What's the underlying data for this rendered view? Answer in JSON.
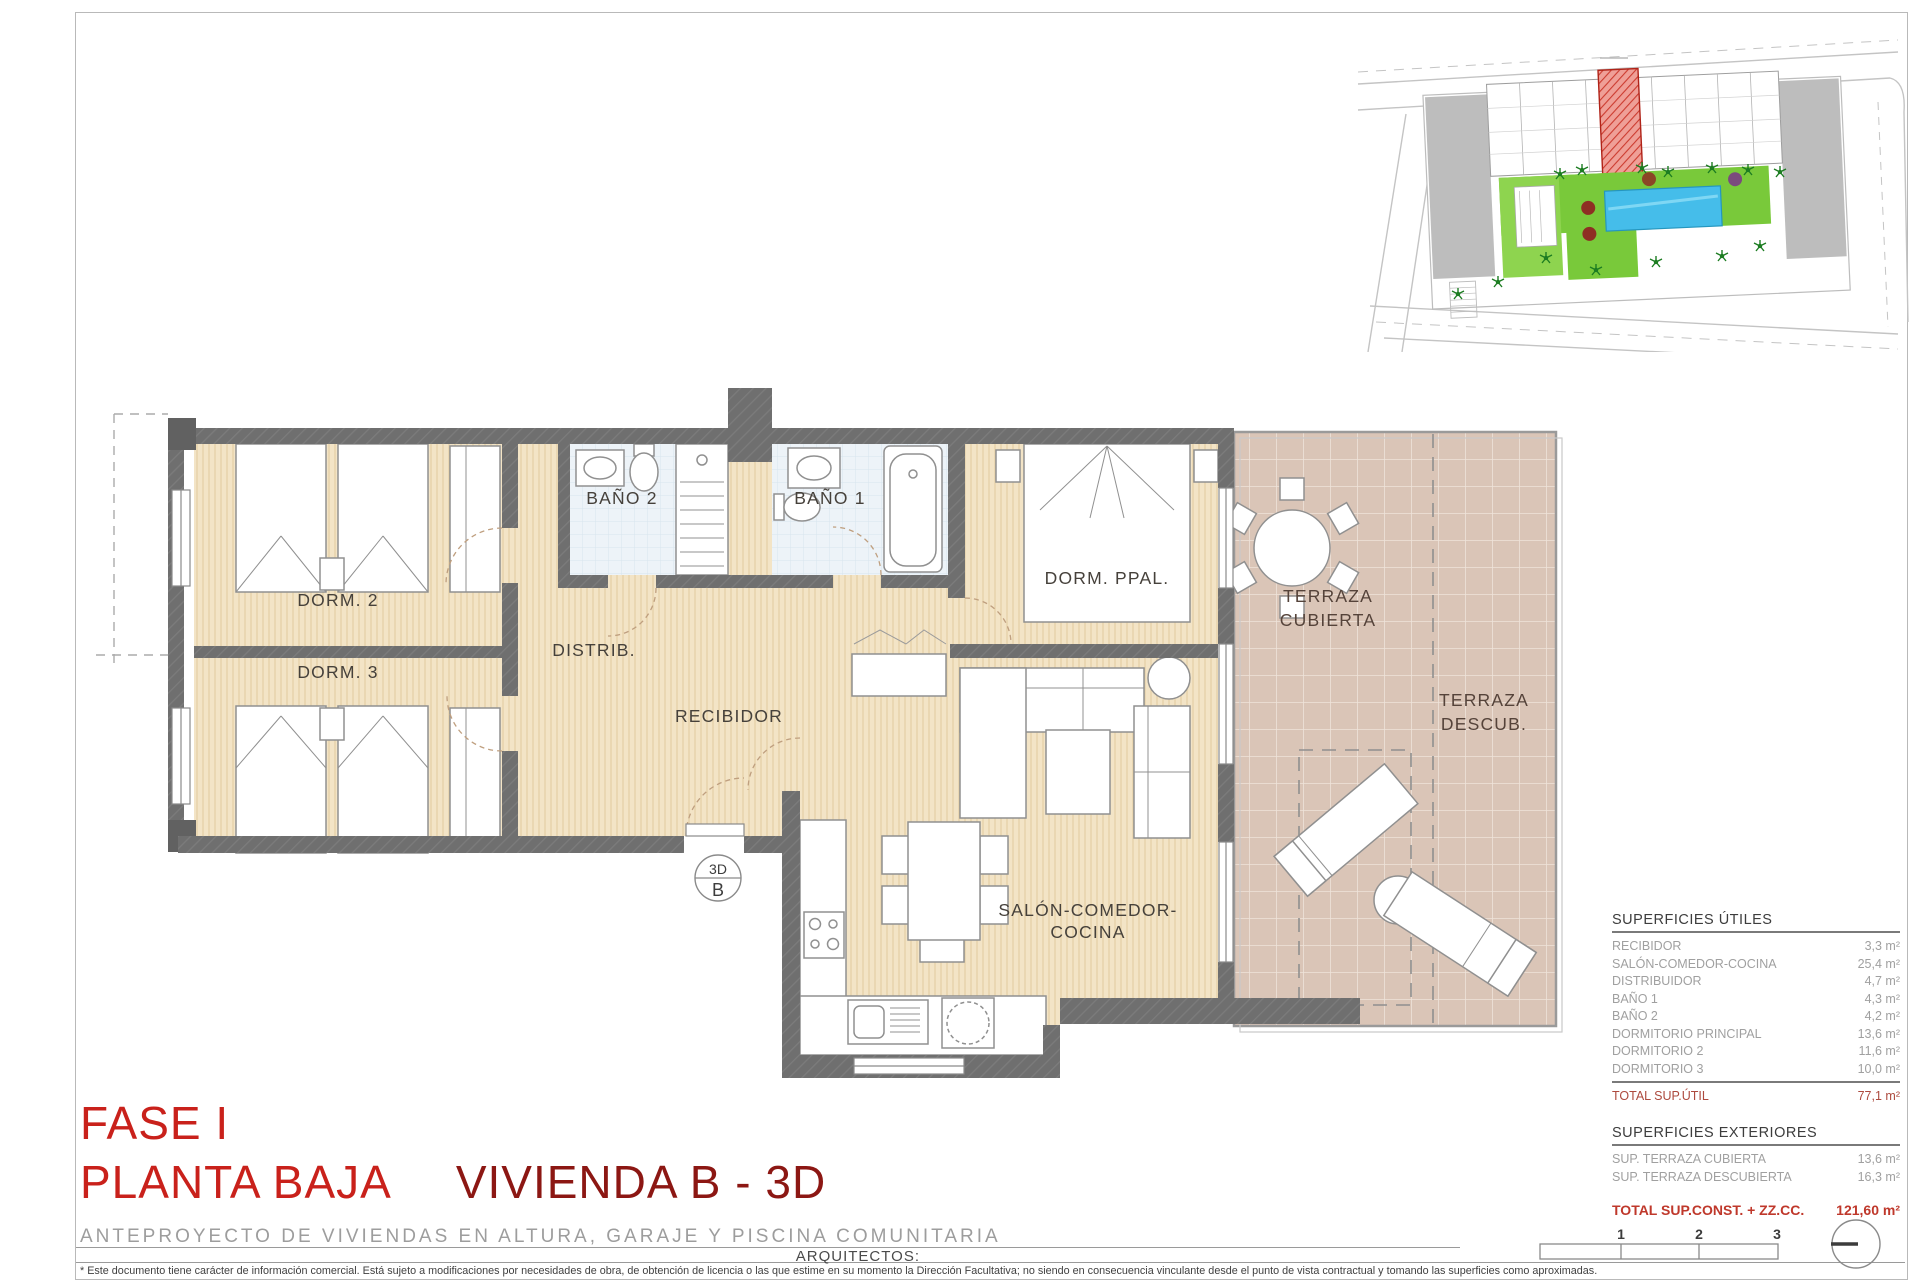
{
  "titles": {
    "fase": "FASE I",
    "planta": "PLANTA BAJA",
    "vivienda": "VIVIENDA B - 3D",
    "subtitle": "ANTEPROYECTO DE VIVIENDAS EN ALTURA, GARAJE Y PISCINA COMUNITARIA",
    "arquitectos": "ARQUITECTOS:",
    "disclaimer": "* Este documento tiene carácter de información comercial. Está sujeto a modificaciones por necesidades de obra, de obtención de licencia o las que estime en su momento la Dirección Facultativa; no siendo en consecuencia vinculante desde el punto de vista contractual y tomando las superficies como aproximadas."
  },
  "floor_plan": {
    "rooms": {
      "dorm2": "DORM. 2",
      "dorm3": "DORM. 3",
      "bano2": "BAÑO 2",
      "bano1": "BAÑO 1",
      "distrib": "DISTRIB.",
      "recibidor": "RECIBIDOR",
      "dorm_ppal": "DORM. PPAL.",
      "salon_line1": "SALÓN-COMEDOR-",
      "salon_line2": "COCINA",
      "terraza_cub_line1": "TERRAZA",
      "terraza_cub_line2": "CUBIERTA",
      "terraza_desc_line1": "TERRAZA",
      "terraza_desc_line2": "DESCUB."
    },
    "marker": {
      "top": "3D",
      "bottom": "B"
    }
  },
  "tables": {
    "utiles": {
      "title": "SUPERFICIES ÚTILES",
      "rows": [
        [
          "RECIBIDOR",
          "3,3 m²"
        ],
        [
          "SALÓN-COMEDOR-COCINA",
          "25,4 m²"
        ],
        [
          "DISTRIBUIDOR",
          "4,7 m²"
        ],
        [
          "BAÑO 1",
          "4,3 m²"
        ],
        [
          "BAÑO 2",
          "4,2 m²"
        ],
        [
          "DORMITORIO PRINCIPAL",
          "13,6 m²"
        ],
        [
          "DORMITORIO 2",
          "11,6 m²"
        ],
        [
          "DORMITORIO 3",
          "10,0 m²"
        ]
      ],
      "total_label": "TOTAL SUP.ÚTIL",
      "total_value": "77,1 m²"
    },
    "exteriores": {
      "title": "SUPERFICIES EXTERIORES",
      "rows": [
        [
          "SUP. TERRAZA CUBIERTA",
          "13,6 m²"
        ],
        [
          "SUP. TERRAZA DESCUBIERTA",
          "16,3 m²"
        ]
      ],
      "total_label": "TOTAL SUP.CONST. + ZZ.CC.",
      "total_value": "121,60 m²"
    }
  },
  "scale_bar": {
    "labels": [
      "1",
      "2",
      "3"
    ]
  },
  "colors": {
    "wall": "#6f6f6f",
    "wood_floor": "#f3e4c6",
    "bath_floor": "#edf3f8",
    "terrace_floor": "#dac5b7",
    "title_red": "#c9211b",
    "title_dark_red": "#8c1713",
    "total_red": "#bf382b",
    "site_highlight": "#e0695c",
    "pool_blue": "#45bdea",
    "garden_green": "#72c636"
  }
}
